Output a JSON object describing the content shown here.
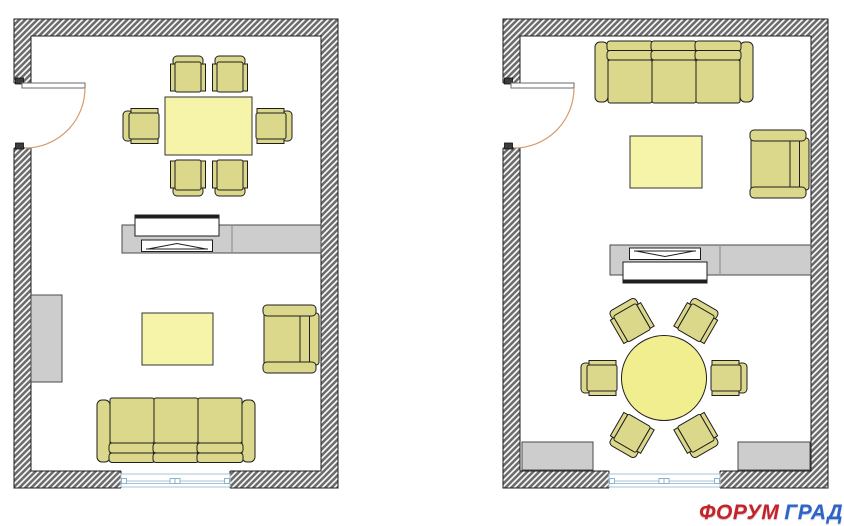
{
  "watermark": {
    "word1": "ФОРУМ",
    "word2": "ГРАД",
    "color1": "#c4232b",
    "color2": "#2e64c8"
  },
  "palette": {
    "wall_fill": "#6e6e6e",
    "wall_hatch": "#ffffff",
    "line": "#1e1e1e",
    "gray_fill": "#cdcdcd",
    "gray_line": "#4a4a4a",
    "table_fill": "#f6f4a8",
    "round_table_fill": "#f1ee8f",
    "seat_fill": "#dcd88b",
    "door_arc": "#d99a6a",
    "door_leaf_line": "#6a6a6a",
    "window_line": "#a4c6da",
    "white": "#ffffff"
  },
  "plans": [
    {
      "name": "left-floor-plan",
      "outer": {
        "x": 14,
        "y": 19,
        "w": 324,
        "h": 469
      },
      "wall": 17,
      "door": {
        "open_y1": 83,
        "open_y2": 148,
        "leaf_len": 63
      },
      "window": {
        "x1": 121,
        "x2": 230
      },
      "furniture": [
        {
          "type": "table",
          "name": "dining-table",
          "x": 165,
          "y": 97,
          "w": 87,
          "h": 58
        },
        {
          "type": "chair",
          "name": "dining-chair",
          "cx": 188,
          "cy": 75,
          "rot": 0
        },
        {
          "type": "chair",
          "name": "dining-chair",
          "cx": 230,
          "cy": 75,
          "rot": 0
        },
        {
          "type": "chair",
          "name": "dining-chair",
          "cx": 142,
          "cy": 126,
          "rot": 270
        },
        {
          "type": "chair",
          "name": "dining-chair",
          "cx": 273,
          "cy": 126,
          "rot": 90
        },
        {
          "type": "chair",
          "name": "dining-chair",
          "cx": 188,
          "cy": 177,
          "rot": 180
        },
        {
          "type": "chair",
          "name": "dining-chair",
          "cx": 230,
          "cy": 177,
          "rot": 180
        },
        {
          "type": "tv-stand",
          "name": "tv-stand",
          "x": 122,
          "y": 225,
          "w": 199,
          "h": 28,
          "divider_x": 232,
          "tv_cx": 177,
          "facing": "up"
        },
        {
          "type": "cabinet",
          "name": "wall-cabinet",
          "x": 31,
          "y": 295,
          "w": 31,
          "h": 87
        },
        {
          "type": "table",
          "name": "coffee-table",
          "x": 142,
          "y": 313,
          "w": 71,
          "h": 52
        },
        {
          "type": "armchair",
          "name": "armchair",
          "x": 263,
          "y": 305,
          "w": 57,
          "h": 68
        },
        {
          "type": "sofa",
          "name": "sofa-three-seat",
          "x": 97,
          "y": 398,
          "w": 158,
          "h": 66,
          "facing": "up"
        }
      ]
    },
    {
      "name": "right-floor-plan",
      "outer": {
        "x": 503,
        "y": 19,
        "w": 325,
        "h": 469
      },
      "wall": 17,
      "door": {
        "open_y1": 83,
        "open_y2": 148,
        "leaf_len": 63
      },
      "window": {
        "x1": 609,
        "x2": 720
      },
      "furniture": [
        {
          "type": "sofa",
          "name": "sofa-three-seat",
          "x": 595,
          "y": 40,
          "w": 158,
          "h": 64,
          "facing": "down"
        },
        {
          "type": "table",
          "name": "coffee-table",
          "x": 630,
          "y": 136,
          "w": 72,
          "h": 52
        },
        {
          "type": "armchair",
          "name": "armchair",
          "x": 750,
          "y": 130,
          "w": 60,
          "h": 68
        },
        {
          "type": "tv-stand",
          "name": "tv-stand",
          "x": 610,
          "y": 245,
          "w": 201,
          "h": 30,
          "divider_x": 720,
          "tv_cx": 665,
          "facing": "down"
        },
        {
          "type": "round-table",
          "name": "round-dining-table",
          "cx": 664,
          "cy": 378,
          "r": 42.5
        },
        {
          "type": "chair",
          "name": "dining-chair",
          "cx": 631,
          "cy": 321,
          "rot": 330
        },
        {
          "type": "chair",
          "name": "dining-chair",
          "cx": 697,
          "cy": 321,
          "rot": 30
        },
        {
          "type": "chair",
          "name": "dining-chair",
          "cx": 728,
          "cy": 378,
          "rot": 90
        },
        {
          "type": "chair",
          "name": "dining-chair",
          "cx": 697,
          "cy": 435,
          "rot": 150
        },
        {
          "type": "chair",
          "name": "dining-chair",
          "cx": 631,
          "cy": 435,
          "rot": 210
        },
        {
          "type": "chair",
          "name": "dining-chair",
          "cx": 600,
          "cy": 378,
          "rot": 270
        },
        {
          "type": "cabinet",
          "name": "corner-cabinet",
          "x": 522,
          "y": 442,
          "w": 71,
          "h": 28
        },
        {
          "type": "cabinet",
          "name": "corner-cabinet",
          "x": 738,
          "y": 442,
          "w": 72,
          "h": 28
        }
      ]
    }
  ]
}
